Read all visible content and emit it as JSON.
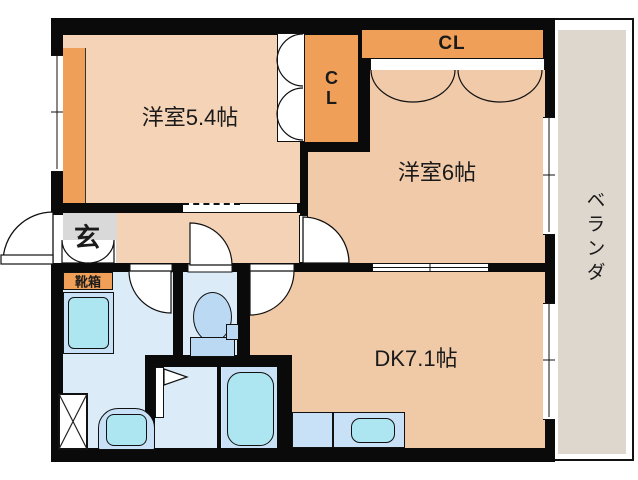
{
  "floorplan": {
    "type": "japanese-apartment-2dk",
    "rooms": {
      "western_room_small": {
        "label": "洋室5.4帖"
      },
      "western_room_large": {
        "label": "洋室6帖"
      },
      "dining_kitchen": {
        "label": "DK7.1帖"
      },
      "closet_top": {
        "label": "CL"
      },
      "closet_middle": {
        "label": "CL"
      },
      "entrance": {
        "label": "玄"
      },
      "shoe_cabinet": {
        "label": "靴箱"
      },
      "veranda": {
        "label": "ベランダ"
      }
    },
    "fixtures": [
      "bathtub",
      "toilet",
      "wash-basin",
      "laundry-pan",
      "washing-machine-space",
      "kitchen-counter",
      "kitchen-sink",
      "entrance-door",
      "sliding-door",
      "bifold-closet-doors",
      "bathroom-folding-door"
    ],
    "colors": {
      "wall": "#0a0a0a",
      "room_small": "#f5d3b6",
      "room_large": "#f0caa9",
      "hallway": "#f4d2b5",
      "dining_kitchen": "#f0c9a7",
      "accent_orange": "#ef9f58",
      "entrance_gray": "#d9d9d9",
      "wet_room": "#dcebf8",
      "fixture_base": "#c9e1f6",
      "fixture_water": "#ade5f1",
      "toilet_fill": "#bcd9f3",
      "veranda_floor": "#ded7ce"
    }
  }
}
